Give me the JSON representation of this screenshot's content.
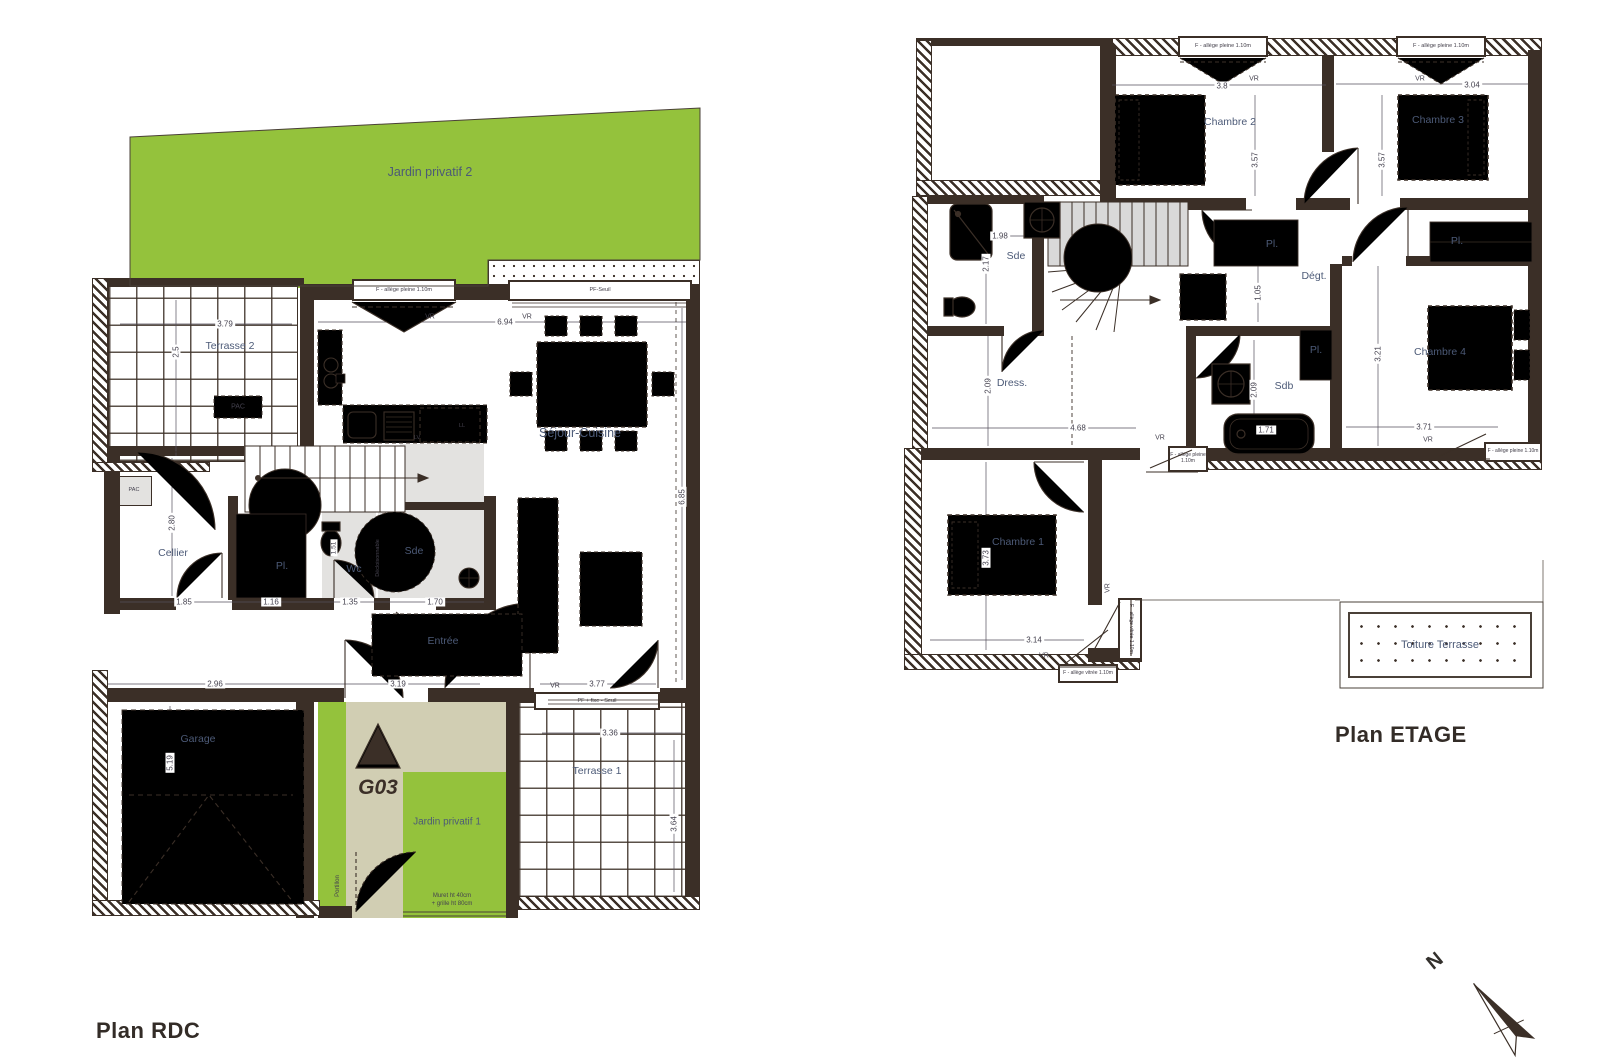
{
  "unit": {
    "marker": "G03"
  },
  "headings": {
    "rdc": "Plan RDC",
    "etage": "Plan ETAGE"
  },
  "compass": {
    "north": "N"
  },
  "window_types": {
    "f_allege_pleine": "F - allège pleine 1.10m",
    "f_allege_vitree": "F - allège vitrée 1.10m",
    "pf_seuil": "PF-Seuil",
    "pf_fixe_seuil": "PF + fixe - Seuil",
    "vr": "VR"
  },
  "rdc": {
    "rooms": {
      "jardin2": "Jardin privatif 2",
      "terrasse2": "Terrasse 2",
      "sejour": "Séjour-Cuisine",
      "cellier": "Cellier",
      "pl": "Pl.",
      "wc": "Wc",
      "sde": "Sde",
      "entree": "Entrée",
      "garage": "Garage",
      "jardin1": "Jardin privatif 1",
      "terrasse1": "Terrasse 1"
    },
    "annotations": {
      "pac_terrasse": "PAC",
      "pac_cellier": "PAC",
      "lv": "LV",
      "ll": "LL",
      "decloisonnable": "Décloisonnable",
      "portillon": "Portillon",
      "muret_line1": "Muret ht 40cm",
      "muret_line2": "+ grille ht 80cm"
    },
    "dims": {
      "terrasse2_w": "3.79",
      "terrasse2_h": "2.5",
      "sejour_w": "6.94",
      "sejour_h": "6.85",
      "cellier_h": "2.80",
      "cellier_w": "1.85",
      "pl_w": "1.16",
      "wc_w": "1.35",
      "sde_w": "1.70",
      "wc_h": "1.51",
      "garage_w": "2.96",
      "garage_h": "5.19",
      "entree_w": "3.19",
      "baie_w": "3.77",
      "terrasse1_w": "3.36",
      "terrasse1_h": "3.64"
    }
  },
  "etage": {
    "rooms": {
      "chambre1": "Chambre 1",
      "chambre2": "Chambre 2",
      "chambre3": "Chambre 3",
      "chambre4": "Chambre 4",
      "sde": "Sde",
      "sdb": "Sdb",
      "dress": "Dress.",
      "degt": "Dégt.",
      "pl_stair": "Pl.",
      "pl_c34": "Pl.",
      "pl_sdb": "Pl.",
      "toiture": "Toiture Terrasse"
    },
    "dims": {
      "c2_w": "3.8",
      "c2_h": "3.57",
      "c3_w": "3.04",
      "c3_h": "3.57",
      "sde_w": "1.98",
      "sde_h": "2.17",
      "pl_h": "1.05",
      "dress_h": "2.09",
      "dress_w": "4.68",
      "sdb_h": "2.09",
      "bain_w": "1.71",
      "c4_h": "3.21",
      "c4_w": "3.71",
      "c1_h": "3.73",
      "c1_w": "3.14"
    }
  }
}
